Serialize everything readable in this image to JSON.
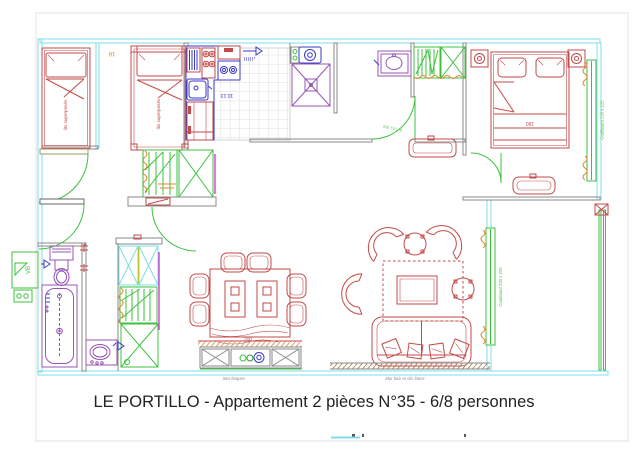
{
  "page": {
    "title": "LE PORTILLO - Appartement 2 pièces N°35 - 6/8 personnes"
  },
  "plan": {
    "labels": {
      "bunk_bed_1": "lits superposés",
      "bunk_bed_2": "lits superposés",
      "dim_head": "16",
      "kitchen_area": "10.13",
      "shower_door": "P: 73 x 203",
      "bed_width": "160",
      "bedroom_window": "Coulissant 220 x 225",
      "living_window": "Coulissant 220 x 225",
      "vb_window": "VB",
      "table_length": "200",
      "brick_wall": "Mur briques",
      "wood_wall": "Mur bois et clin blanc"
    },
    "colors": {
      "exterior_wall": "#7FDCE8",
      "interior_wall": "#8A8A8A",
      "furniture": "#C24A4A",
      "sanitary": "#9457B5",
      "appliances": "#3A3ACB",
      "joinery": "#3CC13C",
      "accent": "#E08830",
      "title_text": "#222222"
    }
  }
}
